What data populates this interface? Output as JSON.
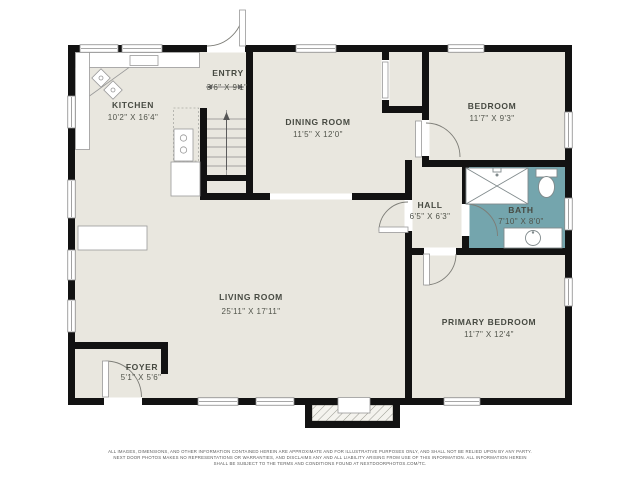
{
  "plan": {
    "title": "floor-plan",
    "rooms": [
      {
        "name": "KITCHEN",
        "dims": "10'2\" X 16'4\""
      },
      {
        "name": "ENTRY",
        "dims": "3'6\" X 9'1\""
      },
      {
        "name": "DINING ROOM",
        "dims": "11'5\" X 12'0\""
      },
      {
        "name": "BEDROOM",
        "dims": "11'7\" X 9'3\""
      },
      {
        "name": "HALL",
        "dims": "6'5\" X 6'3\""
      },
      {
        "name": "BATH",
        "dims": "7'10\" X 8'0\""
      },
      {
        "name": "LIVING ROOM",
        "dims": "25'11\" X 17'11\""
      },
      {
        "name": "PRIMARY BEDROOM",
        "dims": "11'7\" X 12'4\""
      },
      {
        "name": "FOYER",
        "dims": "5'1\" X 5'6\""
      }
    ],
    "colors": {
      "wall": "#121212",
      "floor": "#e9e7df",
      "bath_fill": "#74a5ad",
      "fixture_outline": "#999999"
    }
  },
  "footer": {
    "line1": "ALL IMAGES, DIMENSIONS, AND OTHER INFORMATION CONTAINED HEREIN ARE APPROXIMATE AND FOR ILLUSTRATIVE PURPOSES ONLY, AND SHALL NOT BE RELIED UPON BY ANY PARTY.",
    "line2": "NEXT DOOR PHOTOS MAKES NO REPRESENTATIONS OR WARRANTIES, AND DISCLAIMS ANY AND ALL LIABILITY ARISING FROM USE OF THIS INFORMATION. ALL INFORMATION HEREIN",
    "line3": "SHALL BE SUBJECT TO THE TERMS AND CONDITIONS FOUND AT NEXTDOORPHOTOS.COM/TC."
  }
}
